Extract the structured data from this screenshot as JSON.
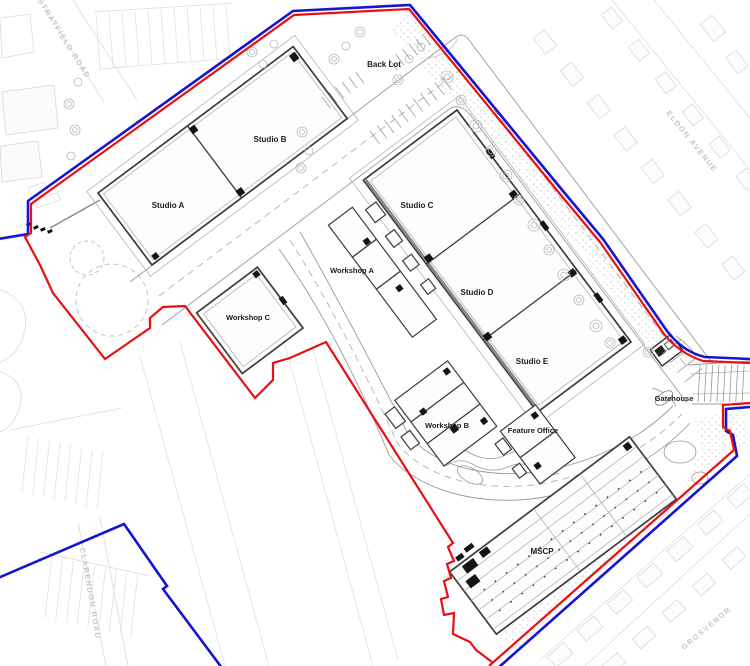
{
  "plan": {
    "buildings": {
      "studio_a": {
        "label": "Studio A"
      },
      "studio_b": {
        "label": "Studio B"
      },
      "studio_c": {
        "label": "Studio C"
      },
      "studio_d": {
        "label": "Studio D"
      },
      "studio_e": {
        "label": "Studio E"
      },
      "workshop_a": {
        "label": "Workshop A"
      },
      "workshop_b": {
        "label": "Workshop B"
      },
      "workshop_c": {
        "label": "Workshop C"
      },
      "feature_office": {
        "label": "Feature Office"
      },
      "gatehouse": {
        "label": "Gatehouse"
      },
      "mscp": {
        "label": "MSCP"
      }
    },
    "areas": {
      "back_lot": {
        "label": "Back Lot"
      }
    },
    "streets": {
      "stratfield": {
        "label": "STRATFIELD ROAD"
      },
      "eldon": {
        "label": "ELDON AVENUE"
      },
      "clarendon": {
        "label": "CLARENDON ROAD"
      },
      "grosvenor": {
        "label": "GROSVENOR"
      }
    },
    "boundary": {
      "outer_color": "#1414d2",
      "inner_color": "#e81010"
    }
  }
}
